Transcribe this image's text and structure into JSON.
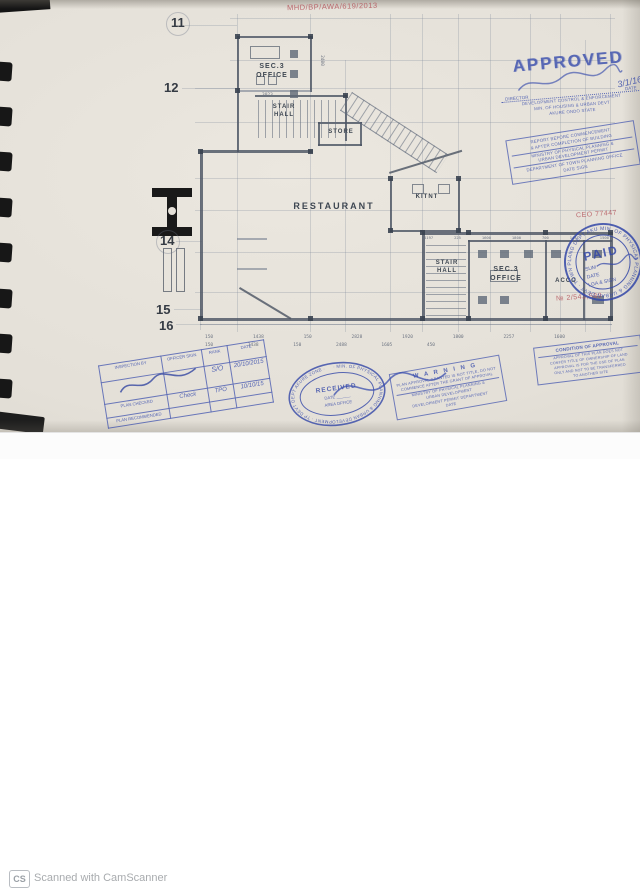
{
  "footer": {
    "cs_logo": "CS",
    "label": "Scanned with CamScanner"
  },
  "red_ink": {
    "file_no": "MHD/BP/AWA/619/2013",
    "ref_no": "CEO 77447",
    "receipt_no": "№ 2/543,580",
    "color": "#b5555c"
  },
  "grid": {
    "g11": "11",
    "g12": "12",
    "g14": "14",
    "g15": "15",
    "g16": "16"
  },
  "plan": {
    "rooms": {
      "office_top_1": "SEC.3",
      "office_top_2": "OFFICE",
      "stair_top_1": "STAIR",
      "stair_top_2": "HALL",
      "store": "STORE",
      "restaurant": "RESTAURANT",
      "kitchen": "KITNT",
      "stair_bottom_1": "STAIR",
      "stair_bottom_2": "HALL",
      "office_bottom_1": "SEC.3",
      "office_bottom_2": "OFFICE",
      "acco": "ACCO"
    },
    "dims": {
      "rowA": [
        "150",
        "1438",
        "150",
        "2828",
        "1920",
        "1800",
        "2257",
        "1600"
      ],
      "rowB": [
        "150",
        "1438",
        "150",
        "2488",
        "1605",
        "450"
      ],
      "wing": [
        "4197",
        "225",
        "1600",
        "1800",
        "700",
        "1431",
        "1500"
      ],
      "v2400": "2400",
      "h3023": "3023"
    }
  },
  "stamps": {
    "blue": "#3a4ead",
    "approved": {
      "title": "APPROVED",
      "director_label": "DIRECTOR",
      "date_label": "DATE",
      "date_value": "3/1/16",
      "line2": "DEVELOPMENT CONTROL & ENFORCEMENT",
      "line3": "MIN. OF HOUSING & URBAN DEVT",
      "line4": "AKURE ONDO STATE"
    },
    "report": {
      "lines": [
        "REPORT BEFORE COMMENCEMENT",
        "& AFTER COMPLETION OF BUILDING",
        "MINISTRY OF PHYSICAL PLANNING &",
        "URBAN DEVELOPMENT PERMIT",
        "DEPARTMENT OF TOWN PLANNING OFFICE",
        "DATE                    SIGN"
      ]
    },
    "paid": {
      "title": "PAID",
      "sum_label": "SUM",
      "date_label": "DATE",
      "lga_label": "LGA & SIGN",
      "ring_text": "· MIN. OF PHYSICAL PLANNING & URBAN DEVT · TOWN PLANG DEPT AKURE ·"
    },
    "inspection": {
      "h1": "INSPECTION BY",
      "h2": "OFFICER SIGN",
      "h3": "RANK",
      "h4": "DATE",
      "row2_label": "PLAN CHECKED",
      "row3_label": "PLAN RECOMMENDED",
      "rank1": "S/O",
      "date1": "20/10/2015",
      "sig2": "Check",
      "rank2": "TPO",
      "date2": "10/10/15"
    },
    "received": {
      "title": "RECEIVED",
      "date_label": "DATE ______",
      "area_label": "AREA OFFICE",
      "ring_text": "· MIN. OF PHYSICAL PLANNING & URBAN DEVELOPMENT · TP DEVT DEPT AKURE ZONE ·"
    },
    "warning": {
      "title": "W A R N I N G",
      "lines": [
        "PLAN APPROVAL GRANTED IS NOT TITLE, DO NOT",
        "COMMENCE AFTER THE GRANT OF APPROVAL",
        "MINISTRY OF PHYSICAL PLANNING &",
        "URBAN DEVELOPMENT",
        "DEVELOPMENT PERMIT DEPARTMENT",
        "DATE"
      ]
    },
    "condition": {
      "title": "CONDITION OF APPROVAL",
      "lines": [
        "APPROVAL OF THIS PLAN DOES NOT",
        "CONFER TITLE OF OWNERSHIP OF LAND",
        "APPROVAL IS FOR THE USE OF PLAN",
        "ONLY AND NOT TO BE TRANSFERRED",
        "TO ANOTHER SITE"
      ]
    }
  }
}
